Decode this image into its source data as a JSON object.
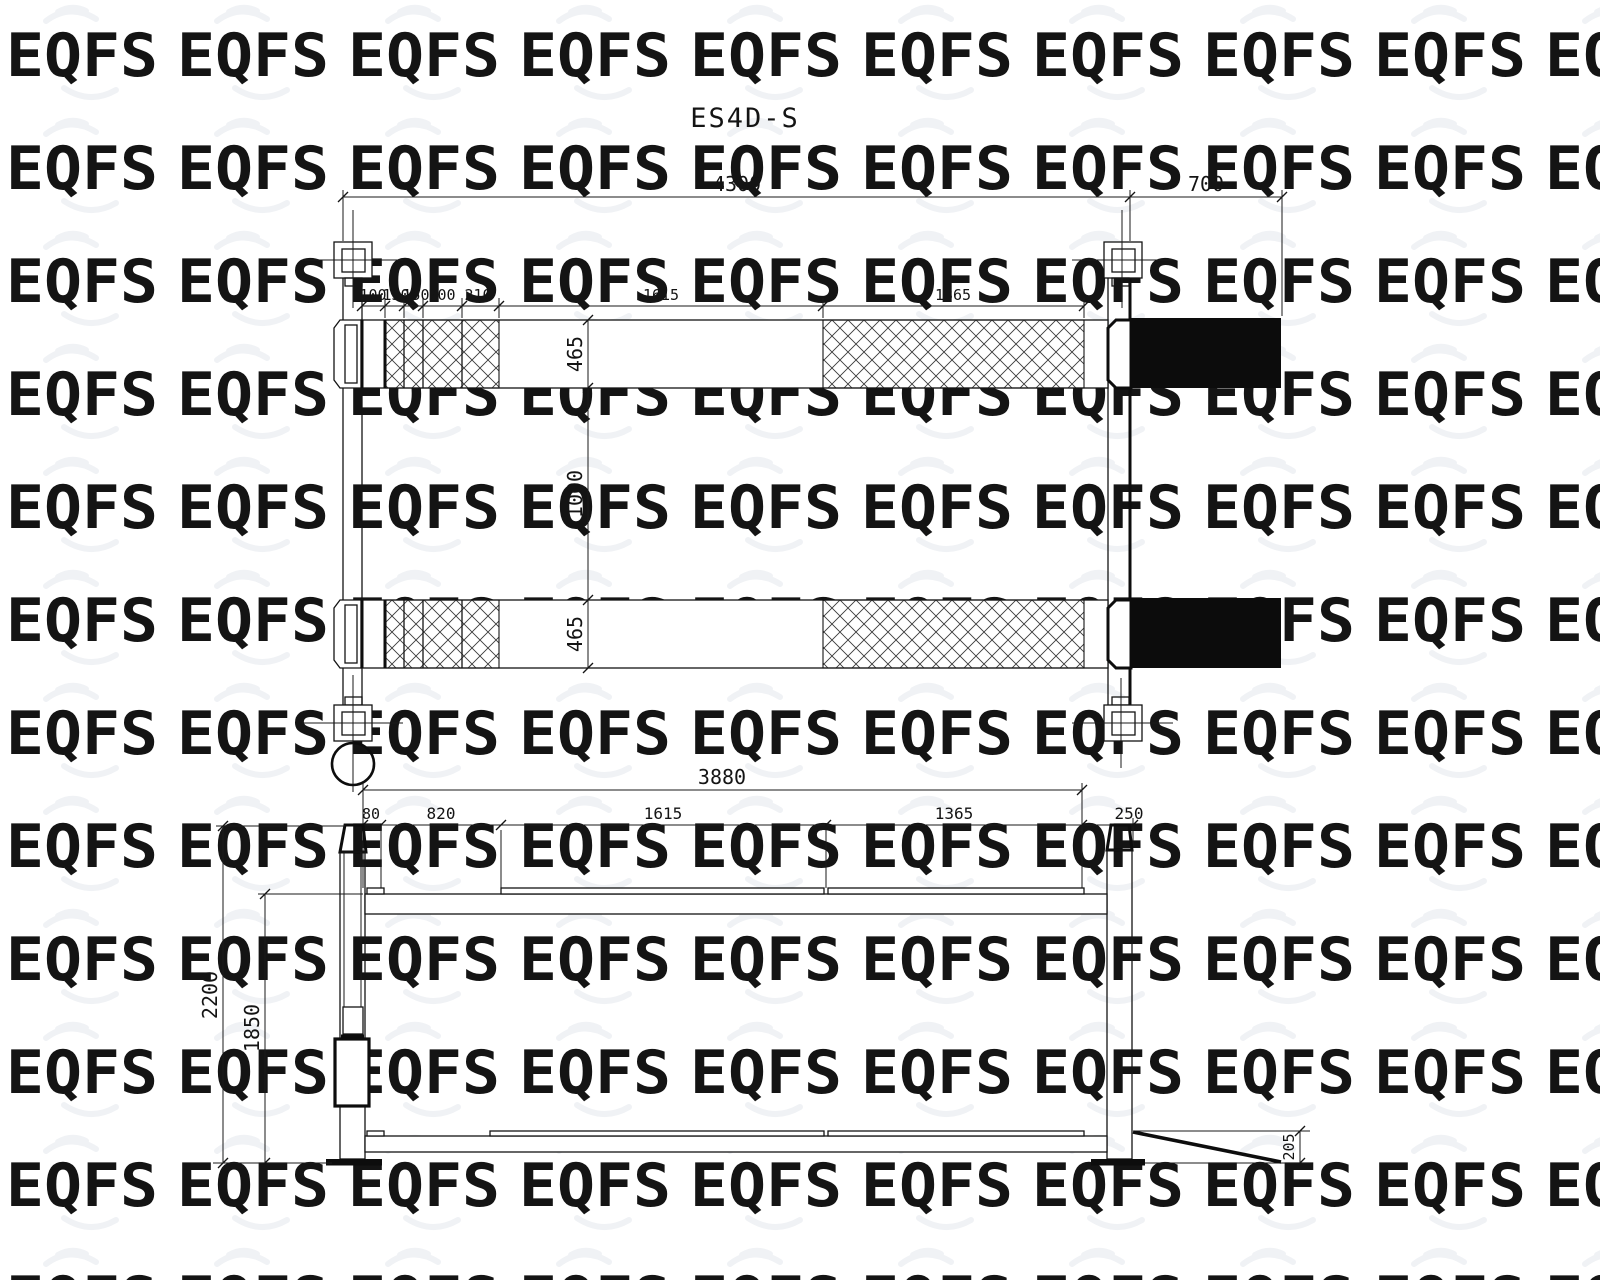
{
  "drawing_title": "ES4D-S",
  "watermark": {
    "text": "EQFS"
  },
  "colors": {
    "line": "#141414",
    "ramp_fill": "#0c0c0c",
    "watermark": "#f0f2f5",
    "background": "#ffffff"
  },
  "plan_view": {
    "overall_length": "4300",
    "ramp_length": "700",
    "segment_dims": [
      "100",
      "150",
      "150",
      "200",
      "210",
      "1615",
      "1365"
    ],
    "cross_dims": [
      "465",
      "1000",
      "465"
    ]
  },
  "side_view": {
    "overall_length": "3880",
    "segment_dims": [
      "80",
      "820",
      "1615",
      "1365",
      "250"
    ],
    "overall_height": "2200",
    "clearance_height": "1850",
    "ramp_height": "205"
  }
}
